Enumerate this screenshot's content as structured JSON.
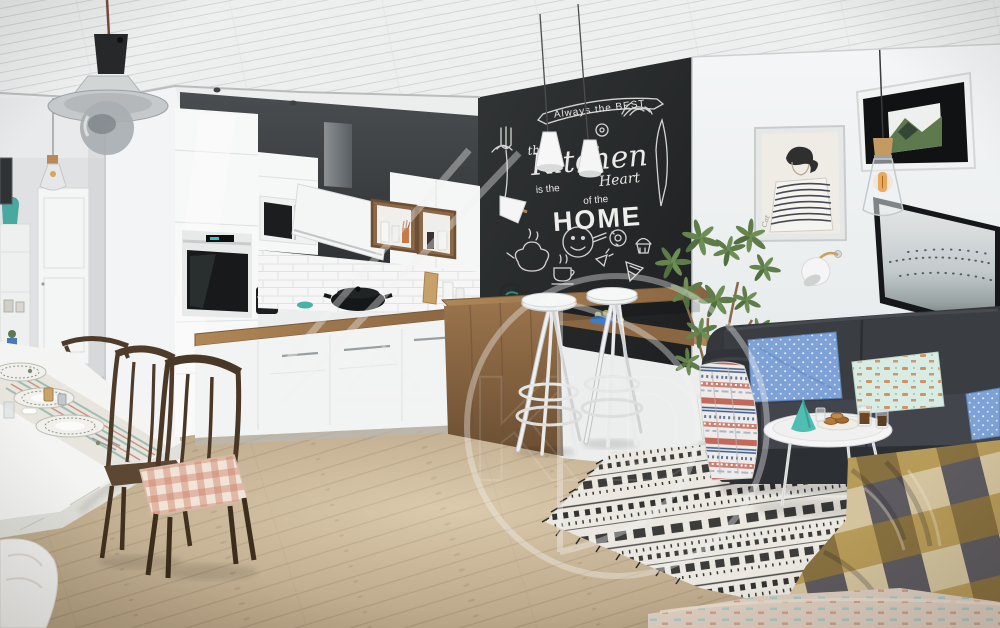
{
  "scene": {
    "description": "3D render of a Scandinavian open-plan kitchen and living room with chalkboard wall, white kitchen, wooden bar with two white bar stools, dark grey sofa, boho rug and dining corner"
  },
  "chalkboard": {
    "banner": "Always the BEST",
    "the": "the",
    "kitchen": "Kitchen",
    "is_the": "is the",
    "heart": "Heart",
    "of_the": "of the",
    "home": "HOME"
  },
  "watermark": {
    "monogram": "KD"
  },
  "artwork": {
    "signature": "Cat"
  },
  "palette": {
    "wall_white": "#eef0f1",
    "chalkboard_black": "#232526",
    "chalk_white": "#e6e6e4",
    "wood_counter": "#9a744c",
    "floor_wood": "#c9b493",
    "sofa_charcoal": "#34373b",
    "accent_teal": "#49b2a8",
    "accent_blue": "#7fa2d6",
    "accent_mint": "#d9ece4",
    "accent_mustard": "#a3812c",
    "accent_red": "#c05a4b"
  }
}
